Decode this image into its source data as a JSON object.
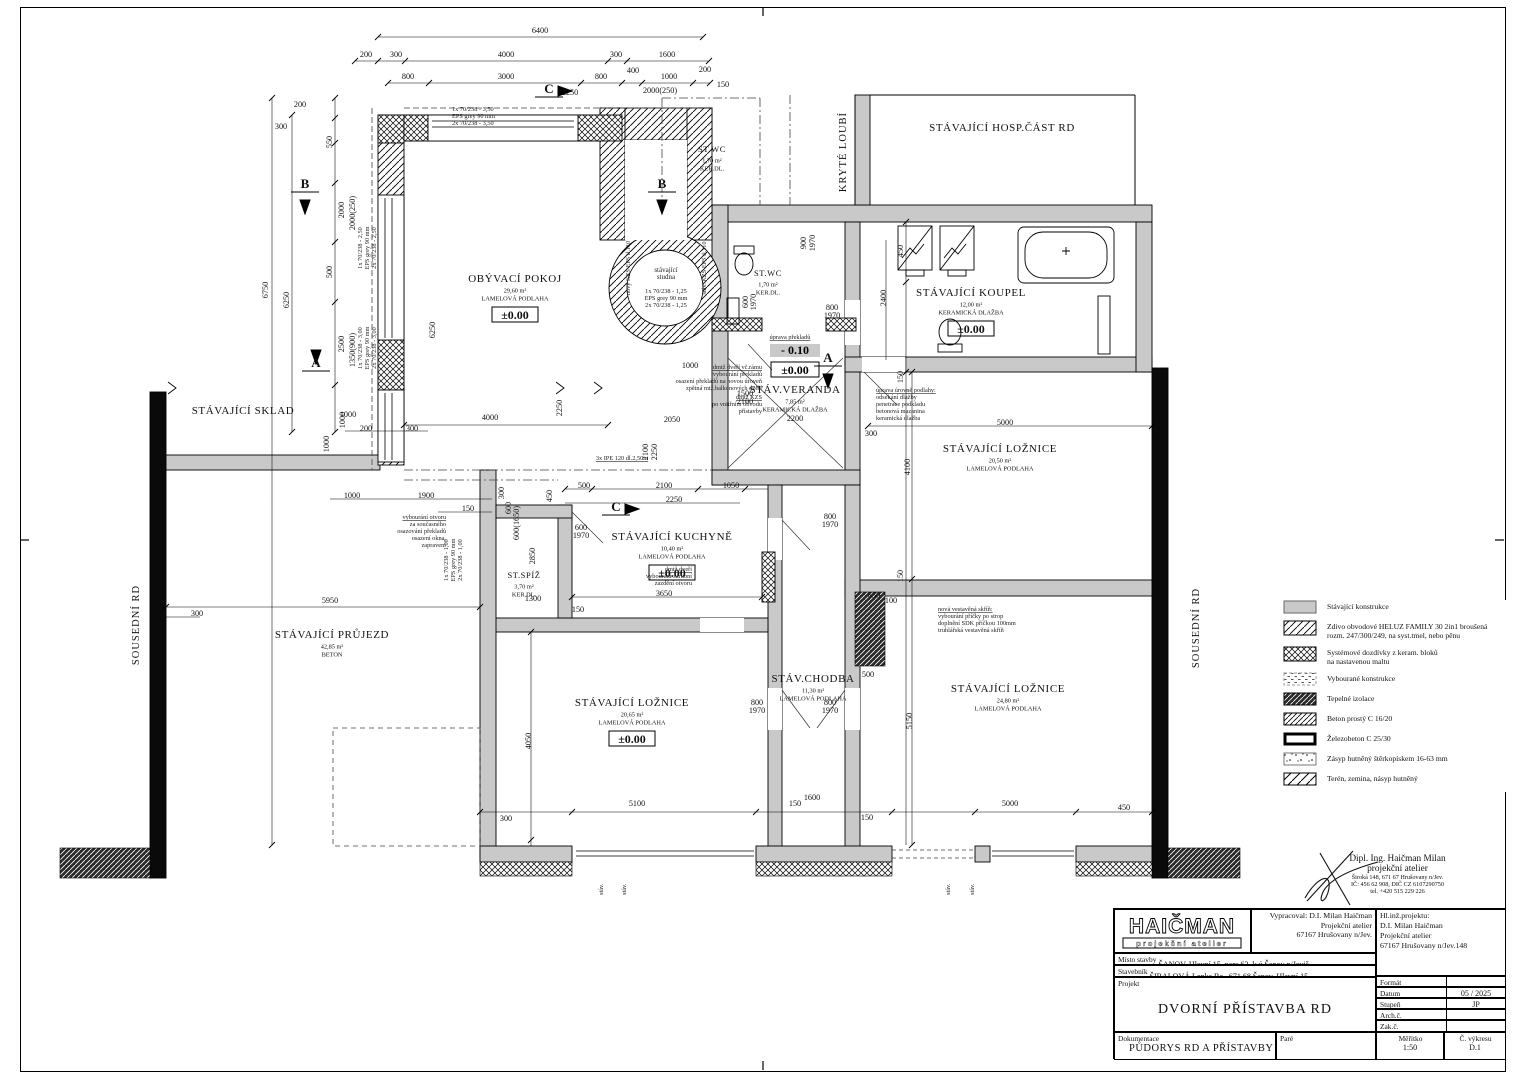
{
  "levels": {
    "zero": "±0.00",
    "minus": "- 0.10"
  },
  "rooms": [
    {
      "name": "OBÝVACÍ POKOJ",
      "area": "29,60 m²",
      "floor": "LAMELOVÁ PODLAHA",
      "level": "±0.00",
      "x": 515,
      "y": 282
    },
    {
      "name": "ST.WC",
      "area": "1,70 m²",
      "floor": "KER.DL.",
      "x": 712,
      "y": 152,
      "small": 1
    },
    {
      "name": "STÁVAJÍCÍ HOSP.ČÁST RD",
      "x": 1002,
      "y": 131
    },
    {
      "name": "KRYTÉ LOUBÍ",
      "x": 846,
      "y": 152,
      "vert": 1
    },
    {
      "name": "ST.WC",
      "area": "1,70 m²",
      "floor": "KER.DL.",
      "x": 768,
      "y": 276,
      "small": 1
    },
    {
      "name": "STÁVAJÍCÍ KOUPEL",
      "area": "12,00 m²",
      "floor": "KERAMICKÁ DLAŽBA",
      "level": "±0.00",
      "x": 971,
      "y": 296
    },
    {
      "name": "STÁV.VERANDA",
      "area": "7,85 m²",
      "floor": "KERAMICKÁ DLAŽBA",
      "x": 795,
      "y": 393
    },
    {
      "name": "STÁVAJÍCÍ LOŽNICE",
      "area": "20,50 m²",
      "floor": "LAMELOVÁ PODLAHA",
      "x": 1000,
      "y": 452
    },
    {
      "name": "STÁVAJÍCÍ KUCHYNĚ",
      "area": "10,40 m²",
      "floor": "LAMELOVÁ PODLAHA",
      "level": "±0.00",
      "x": 672,
      "y": 540
    },
    {
      "name": "ST.SPÍŽ",
      "area": "3,70 m²",
      "floor": "KER.DL.",
      "x": 524,
      "y": 578,
      "small": 1
    },
    {
      "name": "STÁVAJÍCÍ SKLAD",
      "x": 243,
      "y": 414
    },
    {
      "name": "STÁVAJÍCÍ PRŮJEZD",
      "area": "42,85 m²",
      "floor": "BETON",
      "x": 332,
      "y": 638
    },
    {
      "name": "STÁVAJÍCÍ LOŽNICE",
      "area": "20,65 m²",
      "floor": "LAMELOVÁ PODLAHA",
      "level": "±0.00",
      "x": 632,
      "y": 706
    },
    {
      "name": "STÁV.CHODBA",
      "area": "11,30 m²",
      "floor": "LAMELOVÁ PODLAHA",
      "x": 813,
      "y": 682
    },
    {
      "name": "STÁVAJÍCÍ LOŽNICE",
      "area": "24,80 m²",
      "floor": "LAMELOVÁ PODLAHA",
      "x": 1008,
      "y": 692
    },
    {
      "name": "SOUSEDNÍ RD",
      "x": 139,
      "y": 625,
      "vert": 1
    },
    {
      "name": "SOUSEDNÍ RD",
      "x": 1199,
      "y": 628,
      "vert": 1
    }
  ],
  "dimensions": [
    [
      "6400",
      540,
      33
    ],
    [
      "200",
      366,
      57
    ],
    [
      "300",
      396,
      57
    ],
    [
      "4000",
      506,
      57
    ],
    [
      "300",
      616,
      57
    ],
    [
      "1600",
      667,
      57
    ],
    [
      "800",
      408,
      79
    ],
    [
      "3000",
      506,
      79
    ],
    [
      "800",
      601,
      79
    ],
    [
      "400",
      633,
      73
    ],
    [
      "1000",
      669,
      79
    ],
    [
      "200",
      705,
      72
    ],
    [
      "150",
      723,
      87
    ],
    [
      "2000(250)",
      660,
      93
    ],
    [
      "2250",
      570,
      95
    ],
    [
      "6750",
      268,
      290,
      1
    ],
    [
      "6250",
      289,
      300,
      1
    ],
    [
      "6250",
      435,
      330,
      1
    ],
    [
      "200",
      300,
      107
    ],
    [
      "300",
      281,
      129
    ],
    [
      "550",
      332,
      142,
      1
    ],
    [
      "2000",
      344,
      210,
      1
    ],
    [
      "2000(250)",
      355,
      213,
      1
    ],
    [
      "500",
      332,
      272,
      1
    ],
    [
      "2500",
      344,
      344,
      1
    ],
    [
      "1350(900)",
      355,
      350,
      1
    ],
    [
      "1000",
      345,
      420,
      1
    ],
    [
      "1000",
      348,
      417
    ],
    [
      "200",
      366,
      431
    ],
    [
      "300",
      412,
      431
    ],
    [
      "1000",
      329,
      444,
      1
    ],
    [
      "1000",
      352,
      498
    ],
    [
      "1900",
      426,
      498
    ],
    [
      "150",
      468,
      511
    ],
    [
      "5950",
      330,
      603
    ],
    [
      "300",
      197,
      616
    ],
    [
      "4000",
      490,
      420
    ],
    [
      "2250",
      562,
      408,
      1
    ],
    [
      "2050",
      672,
      422
    ],
    [
      "2100",
      648,
      452,
      1
    ],
    [
      "2250",
      657,
      452,
      1
    ],
    [
      "500",
      584,
      488
    ],
    [
      "2100",
      664,
      488
    ],
    [
      "1050",
      731,
      488
    ],
    [
      "2250",
      674,
      502
    ],
    [
      "600",
      581,
      530
    ],
    [
      "1970",
      581,
      538
    ],
    [
      "3650",
      664,
      596
    ],
    [
      "150",
      578,
      612
    ],
    [
      "1300",
      533,
      601
    ],
    [
      "450",
      552,
      496,
      1
    ],
    [
      "300",
      504,
      493,
      1
    ],
    [
      "600",
      511,
      508,
      1
    ],
    [
      "600(1650)",
      519,
      523,
      1
    ],
    [
      "2850",
      535,
      556,
      1
    ],
    [
      "900",
      806,
      243,
      1
    ],
    [
      "1970",
      815,
      243,
      1
    ],
    [
      "600",
      748,
      302,
      1
    ],
    [
      "1970",
      756,
      302,
      1
    ],
    [
      "800",
      832,
      310
    ],
    [
      "1970",
      832,
      318
    ],
    [
      "1500",
      745,
      396
    ],
    [
      "2100",
      745,
      404
    ],
    [
      "2200",
      795,
      421
    ],
    [
      "450",
      903,
      251,
      1
    ],
    [
      "2400",
      886,
      298,
      1
    ],
    [
      "150",
      903,
      377,
      1
    ],
    [
      "4100",
      910,
      467,
      1
    ],
    [
      "150",
      903,
      576,
      1
    ],
    [
      "5150",
      912,
      721,
      1
    ],
    [
      "5000",
      1005,
      425
    ],
    [
      "300",
      871,
      436
    ],
    [
      "650",
      874,
      598
    ],
    [
      "100",
      891,
      603
    ],
    [
      "500",
      868,
      677
    ],
    [
      "800",
      757,
      705
    ],
    [
      "1970",
      757,
      713
    ],
    [
      "800",
      830,
      705
    ],
    [
      "1970",
      830,
      713
    ],
    [
      "800",
      830,
      519
    ],
    [
      "1970",
      830,
      527
    ],
    [
      "4050",
      531,
      741,
      1
    ],
    [
      "300",
      506,
      821
    ],
    [
      "5100",
      637,
      806
    ],
    [
      "150",
      795,
      806
    ],
    [
      "1600",
      812,
      800
    ],
    [
      "150",
      867,
      820
    ],
    [
      "5000",
      1010,
      806
    ],
    [
      "450",
      1124,
      810
    ],
    [
      "1000",
      690,
      368
    ],
    [
      "B",
      305,
      188
    ],
    [
      "B",
      662,
      188
    ],
    [
      "A",
      316,
      367
    ],
    [
      "A",
      828,
      362
    ],
    [
      "C",
      549,
      93
    ],
    [
      "C",
      616,
      511
    ]
  ],
  "notes": [
    {
      "x": 762,
      "y": 369,
      "a": "end",
      "ul": 1,
      "l": [
        "dmtž dveří vč.rámu",
        "vybourání překladů",
        "osazení překladů na novou úroveň",
        "zpětná mtž.balkonových dveří"
      ]
    },
    {
      "x": 762,
      "y": 399,
      "a": "end",
      "ul": 1,
      "l": [
        "dmtž KZS",
        "po vnitřním obvodu",
        "přístavby"
      ]
    },
    {
      "x": 876,
      "y": 392,
      "a": "start",
      "ul": 1,
      "l": [
        "úprava úrovně podlahy:",
        "odsekání dlažby",
        "penetrace podkladu",
        "betonová mazanina",
        "keramická dlažba"
      ]
    },
    {
      "x": 692,
      "y": 571,
      "a": "end",
      "ul": 1,
      "l": [
        "dmtž dveří",
        "vybourání zárubní",
        "zazdění otvoru"
      ]
    },
    {
      "x": 938,
      "y": 611,
      "a": "start",
      "ul": 1,
      "l": [
        "nová vestavěná skříň:",
        "vybourání příčky po strop",
        "doplnění SDK příčkou 100mm",
        "truhlářská vestavěná skříň"
      ]
    },
    {
      "x": 446,
      "y": 519,
      "a": "end",
      "ul": 1,
      "l": [
        "vybourání otvoru",
        "za současného",
        "osazování překladů",
        "osazení okna,",
        "zapravení"
      ]
    },
    {
      "x": 790,
      "y": 339,
      "a": "middle",
      "ul": 1,
      "l": [
        "úprava překladů"
      ]
    },
    {
      "x": 622,
      "y": 460,
      "a": "middle",
      "ul": 1,
      "l": [
        "3x IPE 120 dl.2,50m"
      ]
    },
    {
      "x": 452,
      "y": 111,
      "a": "start",
      "l": [
        "1x 70/238 - 3,50",
        "EPS grey 90 mm",
        "2x 70/238 - 3,50"
      ]
    },
    {
      "x": 362,
      "y": 248,
      "a": "middle",
      "r": 1,
      "l": [
        "1x 70/238 - 2,50",
        "EPS grey 90 mm",
        "2x 70/238 - 2,50"
      ]
    },
    {
      "x": 362,
      "y": 348,
      "a": "middle",
      "r": 1,
      "l": [
        "1x 70/238 - 3,00",
        "EPS grey 90 mm",
        "2x 70/238 - 3,00"
      ]
    },
    {
      "x": 448,
      "y": 560,
      "a": "middle",
      "r": 1,
      "l": [
        "1x 70/238 - 1,00",
        "EPS grey 90 mm",
        "2x 70/238 - 1,00"
      ]
    },
    {
      "x": 666,
      "y": 272,
      "a": "middle",
      "s": 7,
      "l": [
        "stávající",
        "studna"
      ]
    },
    {
      "x": 666,
      "y": 293,
      "a": "middle",
      "l": [
        "1x 70/238 - 1,25",
        "EPS grey 90 mm",
        "2x 70/238 - 1,25"
      ]
    },
    {
      "x": 630,
      "y": 268,
      "a": "middle",
      "r": 1,
      "l": [
        "nový KZS EPS tl.110"
      ]
    },
    {
      "x": 706,
      "y": 268,
      "a": "middle",
      "r": 1,
      "l": [
        "stáv. KZS EPS tl.110"
      ]
    },
    {
      "x": 603,
      "y": 895,
      "a": "start",
      "r": 1,
      "l": [
        "stáv."
      ]
    },
    {
      "x": 626,
      "y": 895,
      "a": "start",
      "r": 1,
      "l": [
        "stáv."
      ]
    },
    {
      "x": 950,
      "y": 895,
      "a": "start",
      "r": 1,
      "l": [
        "stáv."
      ]
    },
    {
      "x": 974,
      "y": 895,
      "a": "start",
      "r": 1,
      "l": [
        "stáv."
      ]
    }
  ],
  "legend": {
    "items": [
      {
        "lines": [
          "Stávající konstrukce"
        ]
      },
      {
        "lines": [
          "Zdivo obvodové HELUZ FAMILY 30 2in1 broušená",
          "rozm. 247/300/249, na syst.tmel, nebo pěnu"
        ]
      },
      {
        "lines": [
          "Systémové dozdívky z keram. bloků",
          "na nastavenou maltu"
        ]
      },
      {
        "lines": [
          "Vybourané konstrukce"
        ]
      },
      {
        "lines": [
          "Tepelné izolace"
        ]
      },
      {
        "lines": [
          "Beton prostý C 16/20"
        ]
      },
      {
        "lines": [
          "Železobeton C 25/30"
        ]
      },
      {
        "lines": [
          "Zásyp hutněný štěrkopískem 16-63 mm"
        ]
      },
      {
        "lines": [
          "Terén, zemina, násyp hutněný"
        ]
      }
    ]
  },
  "stamp": {
    "lines": [
      "Dipl. Ing. Haičman Milan",
      "projekční atelier",
      "Široká 148, 671 67 Hrušovany n/Jev.",
      "IČ: 456 62 908, DIČ CZ 6107290750",
      "tel. +420 515 229 226"
    ]
  },
  "titleblock": {
    "logo_name": "HAIČMAN",
    "logo_sub": "projekční atelier",
    "vypracoval_label": "Vypracoval:",
    "vypracoval_name": "D.I. Milan Haičman",
    "vypracoval_l2": "Projekční atelier",
    "vypracoval_l3": "67167 Hrušovany n/Jev.",
    "hlinz_label": "Hl.inž.projektu:",
    "hlinz_name": "D.I. Milan Haičman",
    "hlinz_l2": "Projekční atelier",
    "hlinz_l3": "67167 Hrušovany n/Jev.148",
    "misto_label": "Místo stavby",
    "misto_value": "ŠANOV, Hlavní 15, parc.63, k.ú.Šanov n/Jeviš",
    "stavebnik_label": "Stavebník",
    "stavebnik_value": "ŠIBALOVÁ Lenka Bc., 671 68 Šanov, Hlavní 15",
    "projekt_label": "Projekt",
    "projekt_value": "DVORNÍ PŘÍSTAVBA RD",
    "format_label": "Formát",
    "format_value": "",
    "datum_label": "Datum",
    "datum_value": "05 / 2025",
    "stupen_label": "Stupeň",
    "stupen_value": "JP",
    "arch_label": "Arch.č.",
    "arch_value": "",
    "zak_label": "Zak.č.",
    "zak_value": "",
    "dok_label": "Dokumentace",
    "dok_value": "PŮDORYS RD A PŘÍSTAVBY",
    "pare_label": "Paré",
    "meritko_label": "Měřítko",
    "meritko_value": "1:50",
    "vykres_label": "Č. výkresu",
    "vykres_value": "D.1"
  }
}
